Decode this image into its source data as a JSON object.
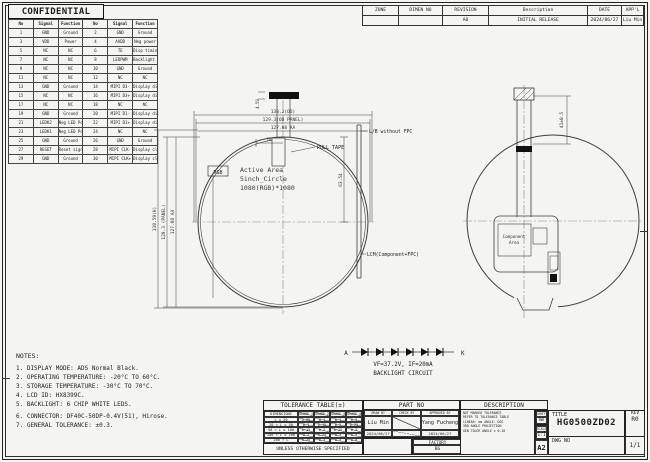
{
  "page": {
    "confidential": "CONFIDENTIAL"
  },
  "pin_table": {
    "headers": [
      "No",
      "Signal",
      "Function",
      "No",
      "Signal",
      "Function"
    ],
    "rows": [
      [
        "1",
        "GND",
        "Ground",
        "2",
        "GND",
        "Ground"
      ],
      [
        "3",
        "VDD",
        "Power",
        "4",
        "AVDD",
        "Neg power"
      ],
      [
        "5",
        "NC",
        "NC",
        "6",
        "TE",
        "Disp timing effect out"
      ],
      [
        "7",
        "NC",
        "NC",
        "8",
        "LEDPWM",
        "Backlight pwm adjust"
      ],
      [
        "9",
        "NC",
        "NC",
        "10",
        "GND",
        "Ground"
      ],
      [
        "11",
        "NC",
        "NC",
        "12",
        "NC",
        "NC"
      ],
      [
        "13",
        "GND",
        "Ground",
        "14",
        "MIPI D3-",
        "Display diff analog sig"
      ],
      [
        "15",
        "NC",
        "NC",
        "16",
        "MIPI D3+",
        "Display diff analog sig"
      ],
      [
        "17",
        "NC",
        "NC",
        "18",
        "NC",
        "NC"
      ],
      [
        "19",
        "GND",
        "Ground",
        "20",
        "MIPI D1-",
        "Display diff analog sig"
      ],
      [
        "21",
        "LEDK2",
        "Neg LED Power 2-",
        "22",
        "MIPI D1+",
        "Display diff analog sig"
      ],
      [
        "23",
        "LEDK1",
        "Neg LED Power 1-",
        "24",
        "NC",
        "NC"
      ],
      [
        "25",
        "GND",
        "Ground",
        "26",
        "GND",
        "Ground"
      ],
      [
        "27",
        "RESET",
        "Reset signal",
        "28",
        "MIPI CLK-",
        "Display clk analog sig"
      ],
      [
        "29",
        "GND",
        "Ground",
        "30",
        "MIPI CLK+",
        "Display clk analog sig"
      ]
    ]
  },
  "revision_table": {
    "headers": [
      "ZONE",
      "DIMEN NO",
      "REVISION",
      "Description",
      "DATE",
      "APP'L"
    ],
    "rows": [
      [
        "",
        "",
        "A0",
        "INITIAL RELEASE",
        "2024/06/27",
        "Liu Min"
      ]
    ]
  },
  "drawing": {
    "left_view": {
      "dim_width_outline": "130.2(OD)",
      "dim_width_panel": "129.3(OD PANEL)",
      "dim_width_aa": "127.08 AA",
      "dim_height_outline": "138.59(H)",
      "dim_height_panel": "129.3 (PANEL)",
      "dim_height_aa": "127.08 AA",
      "dim_tab_width": "20",
      "dim_connector": "4.59",
      "dim_radius": "63.54",
      "pull_tape_label": "PULL TAPE",
      "rgb_label": "RGB",
      "active_area_line1": "Active Area",
      "active_area_line2": "5inch_Circle",
      "active_area_line3": "1080(RGB)*1080"
    },
    "side_view": {
      "label_top": "L/B without FPC",
      "label_bottom": "LCM(Component+FPC)"
    },
    "right_view": {
      "component_area_line1": "Component",
      "component_area_line2": "Area",
      "dim_fpc_length": "41±0.5"
    },
    "backlight": {
      "anode": "A",
      "cathode": "K",
      "spec": "VF=37.2V, IF=20mA",
      "label": "BACKLIGHT CIRCUIT"
    }
  },
  "notes": {
    "title": "NOTES:",
    "items": [
      "1. DISPLAY MODE: ADS Normal Black.",
      "2. OPERATING TEMPERATURE: -20°C TO 60°C.",
      "3. STORAGE TEMPERATURE: -30°C TO 70°C.",
      "4. LCD ID: HX8399C.",
      "5. BACKLIGHT: 6 CHIP WHITE LEDS.",
      "6. CONNECTOR: DF40C-50DP-0.4V(51), Hirose.",
      "7. GENERAL TOLERANCE: ±0.3."
    ]
  },
  "tolerance_table": {
    "title": "TOLERANCE TABLE(±)",
    "col_header": "DIMENSIONS",
    "grade_headers": [
      "GRADE 1",
      "GRADE 2",
      "GRADE 3",
      "GRADE 4"
    ],
    "rows": [
      [
        "L ≤ 20",
        "0.05",
        "0.1",
        "0.1",
        "0.2"
      ],
      [
        "20 < L ≤ 50",
        "0.1",
        "0.15",
        "0.2",
        "0.25"
      ],
      [
        "50 < L ≤ 100",
        "0.15",
        "0.2",
        "0.25",
        "0.3"
      ],
      [
        "100 < L ≤ 200",
        "0.2",
        "0.25",
        "0.3",
        "0.5"
      ],
      [
        "200 < L",
        "0.25",
        "0.3",
        "0.5",
        "0.8"
      ]
    ],
    "footer": "UNLESS OTHERWISE SPECIFIED"
  },
  "title_block": {
    "part_no_label": "PART NO",
    "description_label": "DESCRIPTION",
    "sign_columns": [
      {
        "role": "DRAW BY",
        "name": "Liu Min",
        "date": "2024/06/27"
      },
      {
        "role": "CHECK BY",
        "name": "",
        "date": ""
      },
      {
        "role": "APPROVED BY",
        "name": "Yang Fucheng",
        "date": "2024/06/27"
      }
    ],
    "factory_label": "FACTORY",
    "factory_value": "BG",
    "standards_lines": [
      "NOT MARKED TOLERANCE",
      "REFER TO TOLERANCE TABLE",
      "LINEAR: mm  ANGLE: DEG",
      "3RD ANGLE PROJECTION",
      "GEN TOLER ANGLE ± 0.10"
    ],
    "unit_label": "UNIT",
    "unit_value": "mm",
    "scale_label": "SCALE",
    "scale_value": "1:1",
    "sheet_size": "A2",
    "title_label": "TITLE",
    "title_value": "HG0500ZD02",
    "dwg_no_label": "DWG NO",
    "rev_label": "REV",
    "rev_value": "R0",
    "sheet_value": "1/1"
  }
}
